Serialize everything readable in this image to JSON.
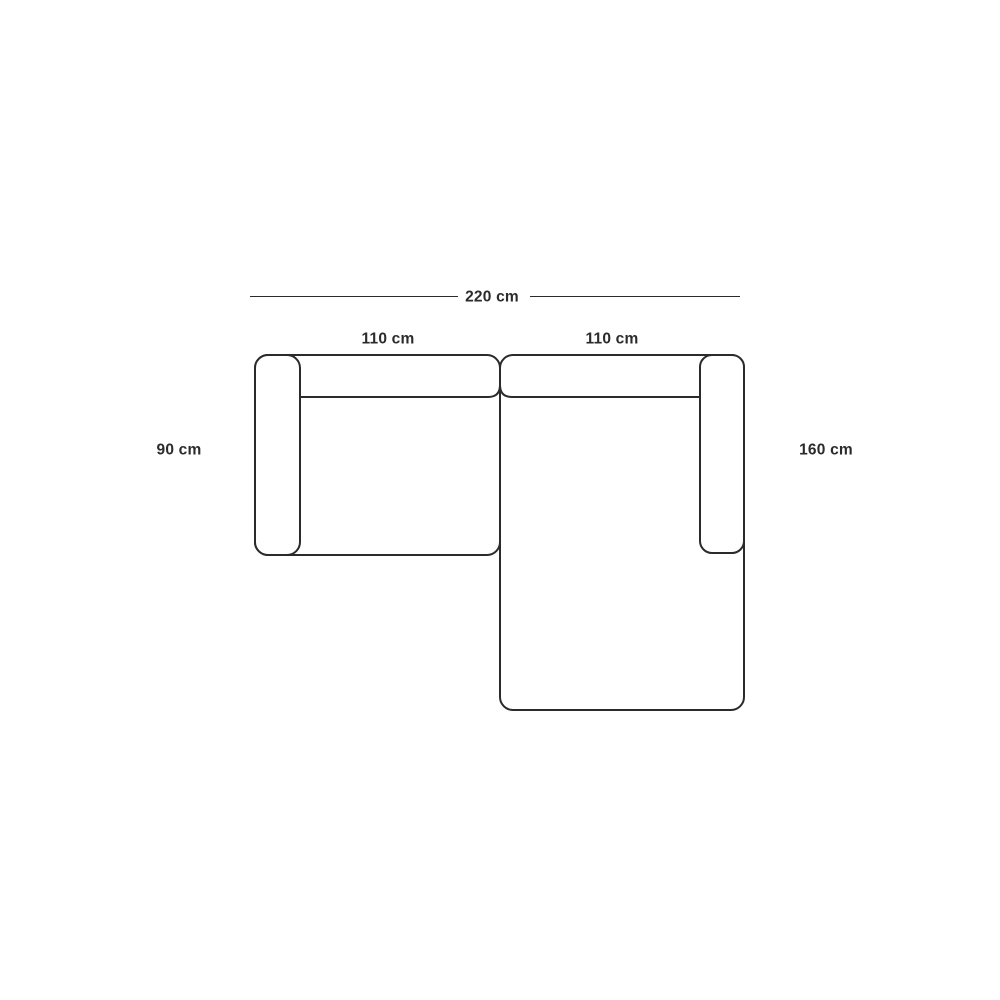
{
  "canvas": {
    "background": "#ffffff",
    "line_color": "#2b2b2b",
    "text_color": "#2b2b2b"
  },
  "diagram": {
    "type": "sofa-top-view-dimension-drawing",
    "description": "Top view schematic of a two-module corner sofa with right chaise",
    "labels": {
      "total_width": "220 cm",
      "left_module_width": "110 cm",
      "right_module_width": "110 cm",
      "left_module_depth": "90 cm",
      "chaise_depth": "160 cm"
    }
  }
}
